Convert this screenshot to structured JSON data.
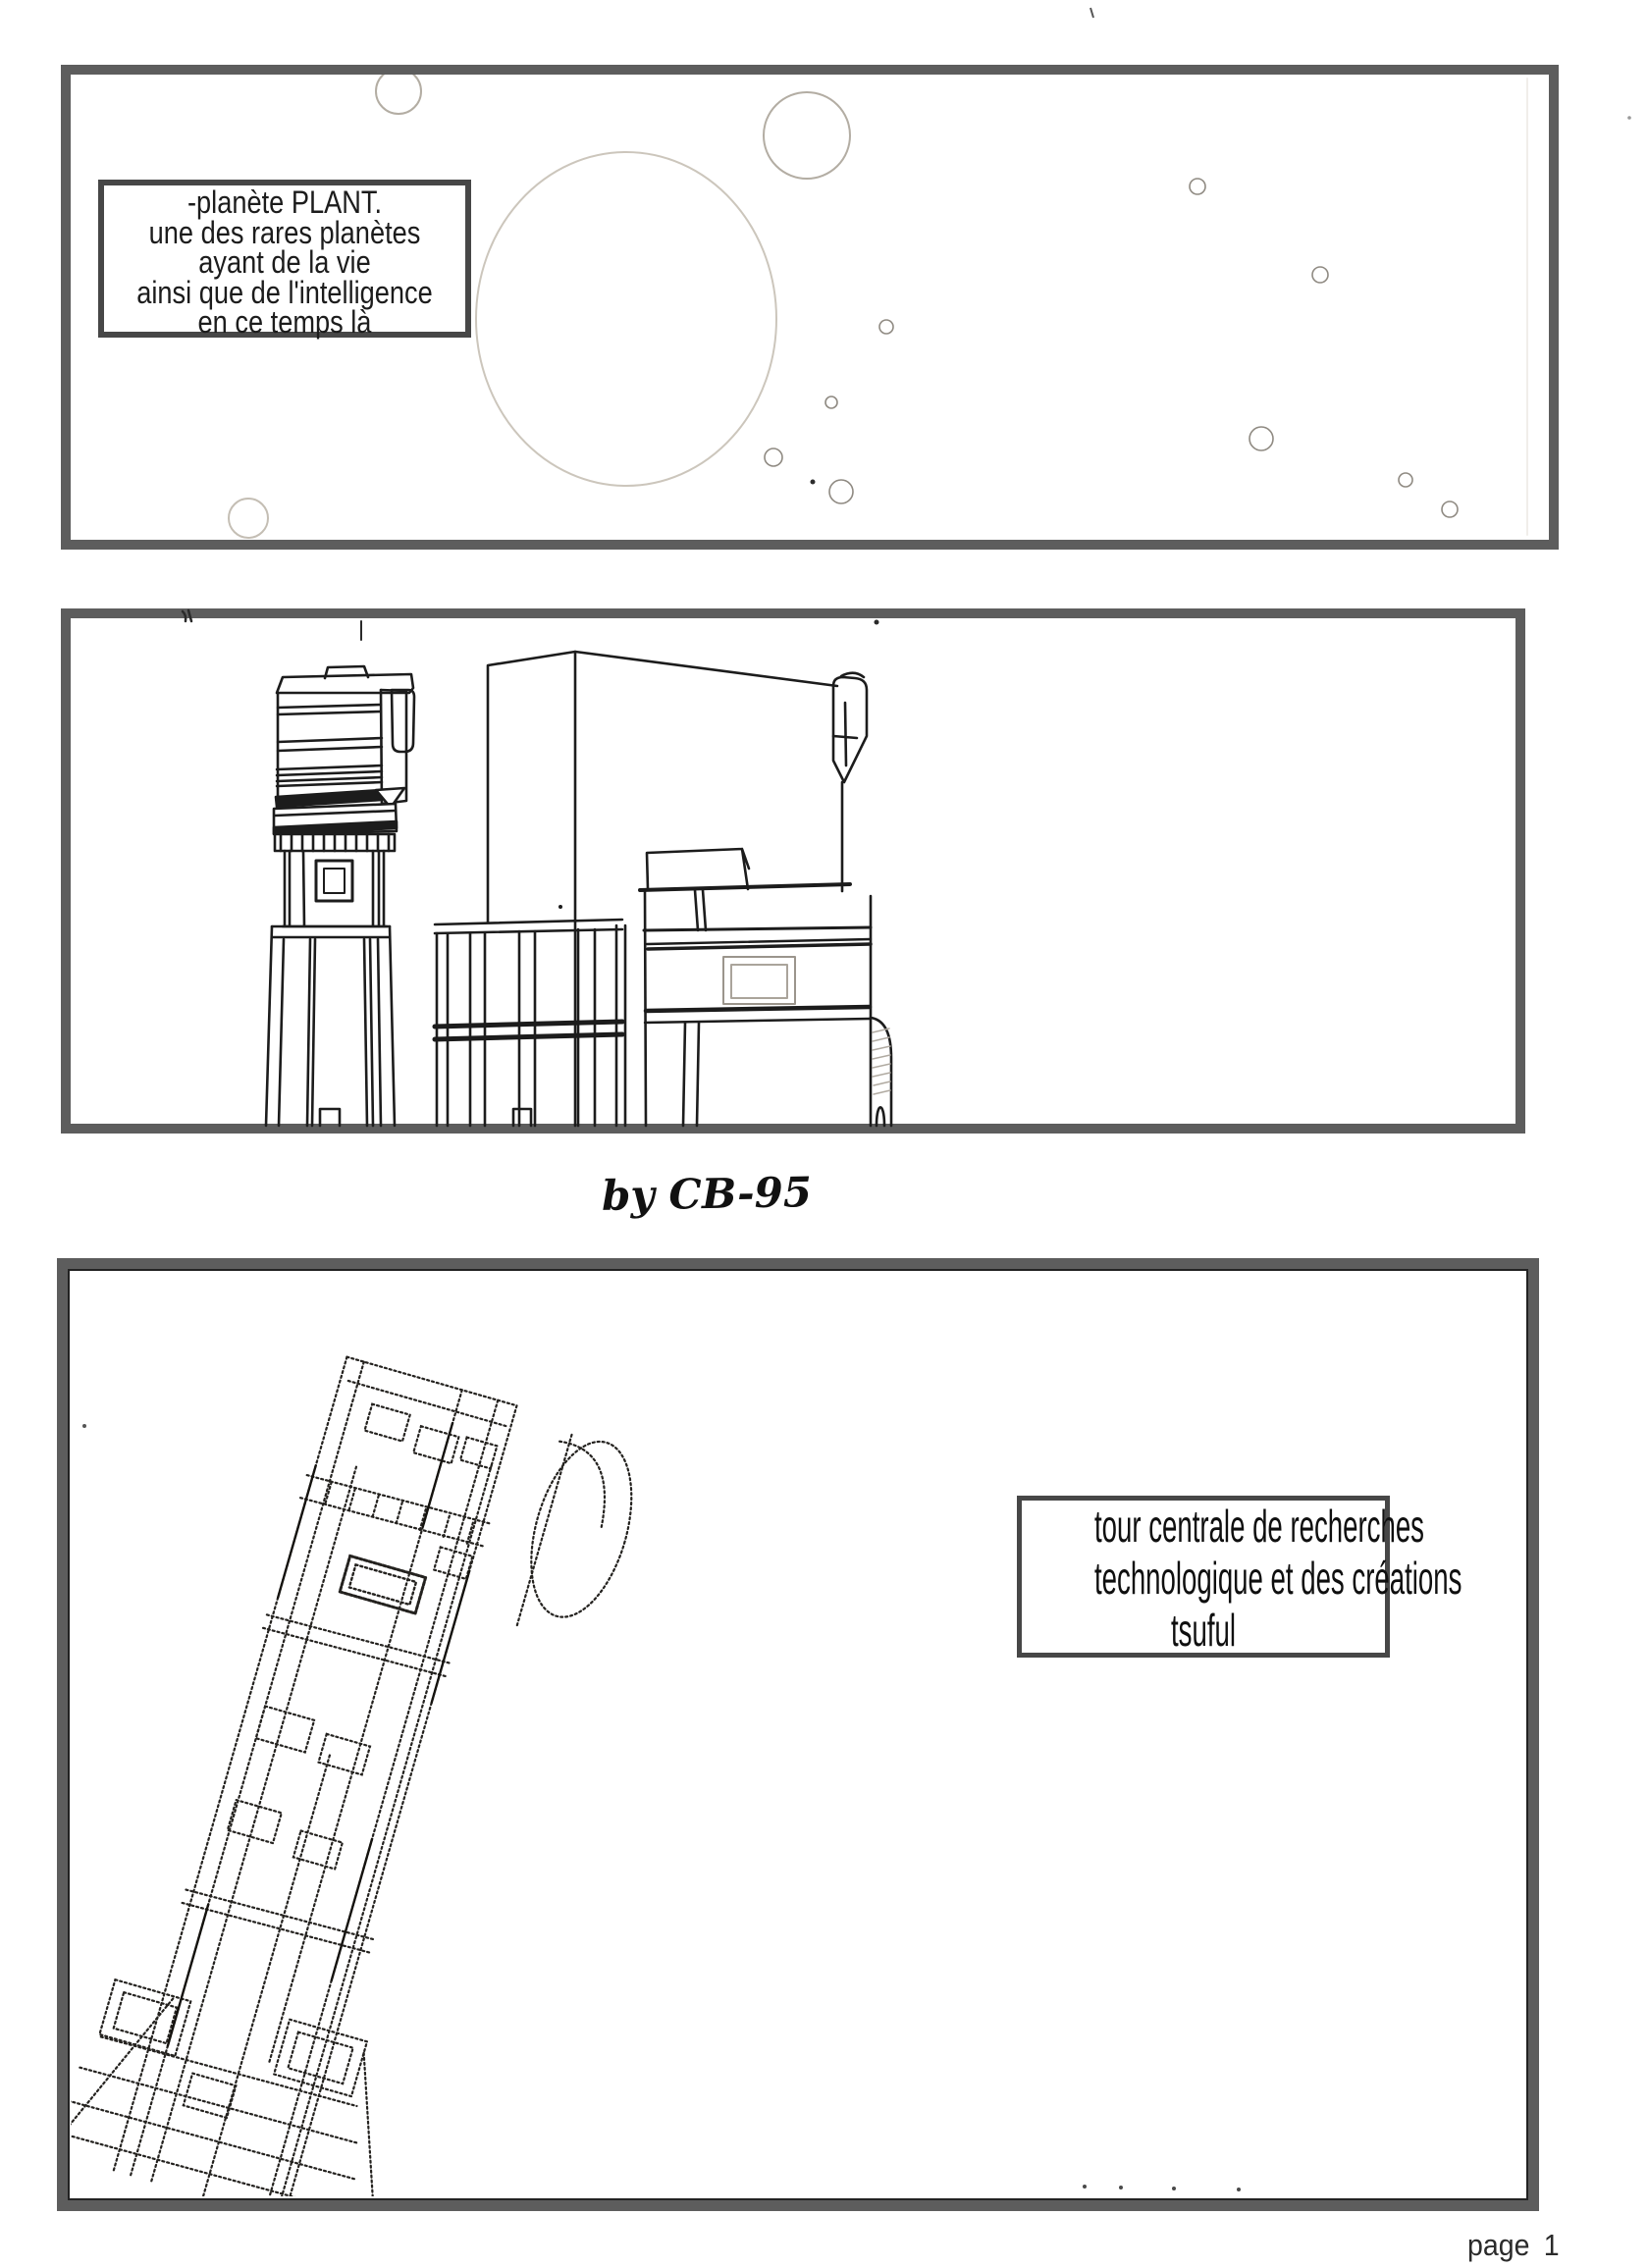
{
  "page": {
    "credit": "by CB-95",
    "page_number": "page 1"
  },
  "captions": {
    "planet_box": {
      "lines": [
        "-planète PLANT.",
        "une des rares planètes",
        "ayant de la vie",
        "ainsi que de l'intelligence",
        "en ce temps là"
      ]
    },
    "tower_box": {
      "lines": [
        "tour centrale de recherches",
        "technologique et des créations",
        "tsuful"
      ]
    }
  },
  "colors": {
    "page_bg": "#ffffff",
    "panel_border": "#5d5d5d",
    "caption_border": "#474747",
    "ink": "#1c1c1c",
    "pencil_faint": "#c9c3b9",
    "dotted_ink": "#24221f"
  }
}
